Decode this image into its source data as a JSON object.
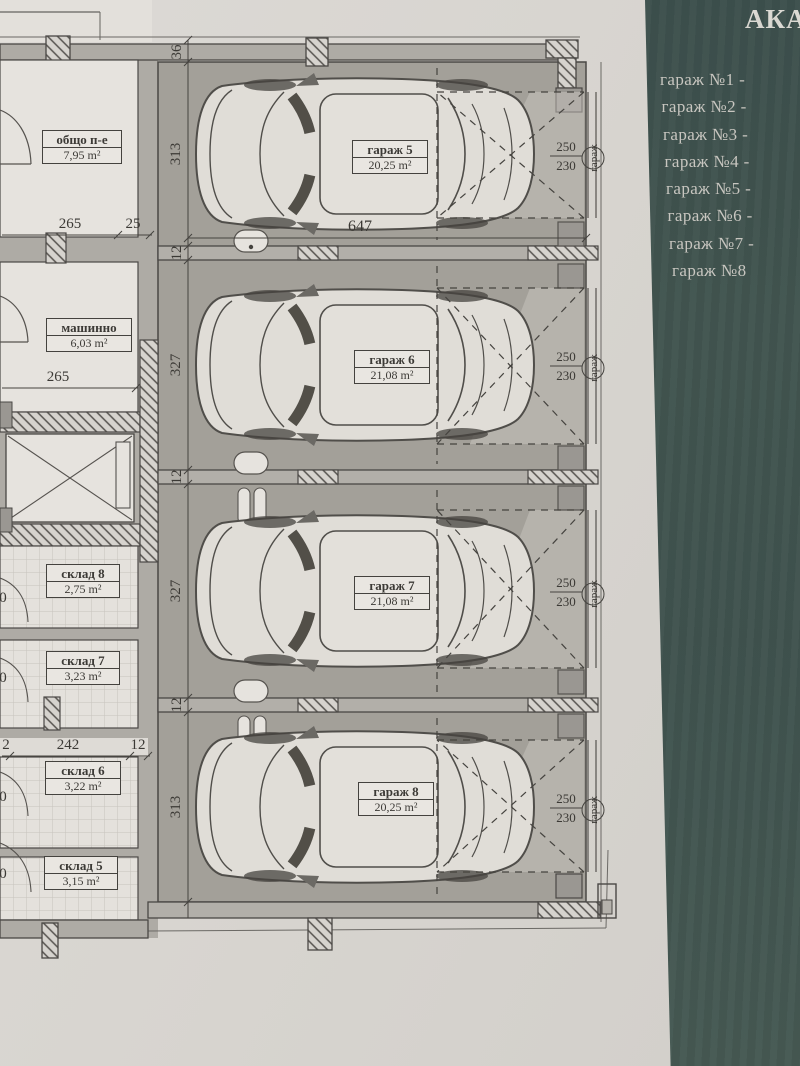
{
  "panel": {
    "title": "АКА",
    "items": [
      "гараж №1 -",
      "гараж №2 -",
      "гараж №3 -",
      "гараж №4 -",
      "гараж №5 -",
      "гараж №6 -",
      "гараж №7 -",
      "гараж №8"
    ]
  },
  "rooms": [
    {
      "name": "общо п-е",
      "area": "7,95 m²"
    },
    {
      "name": "машинно",
      "area": "6,03 m²"
    },
    {
      "name": "склад 8",
      "area": "2,75 m²"
    },
    {
      "name": "склад 7",
      "area": "3,23 m²"
    },
    {
      "name": "склад 6",
      "area": "3,22 m²"
    },
    {
      "name": "склад 5",
      "area": "3,15 m²"
    }
  ],
  "garages": [
    {
      "name": "гараж 5",
      "area": "20,25 m²"
    },
    {
      "name": "гараж 6",
      "area": "21,08 m²"
    },
    {
      "name": "гараж 7",
      "area": "21,08 m²"
    },
    {
      "name": "гараж 8",
      "area": "20,25 m²"
    }
  ],
  "door": {
    "w": "250",
    "h": "230",
    "label": "гараж"
  },
  "dims": {
    "top_offset": "36",
    "g5_h": "313",
    "gap1": "12",
    "g6_h": "327",
    "gap2": "12",
    "g7_h": "327",
    "gap3": "12",
    "g8_h": "313",
    "g_width": "647",
    "r1_w": "265",
    "r1_e": "25",
    "r2_w": "265",
    "sk_edge": "2",
    "sk_w": "242",
    "sk_gap": "12",
    "cut0": "0"
  },
  "colors": {
    "paper": "#d8d5d0",
    "panel_bg": "#41544f",
    "panel_text": "#c8c6c0",
    "floor": "#a3a099",
    "wall": "#aeaba5",
    "room": "#e6e3de",
    "ink": "#3c3a36"
  }
}
